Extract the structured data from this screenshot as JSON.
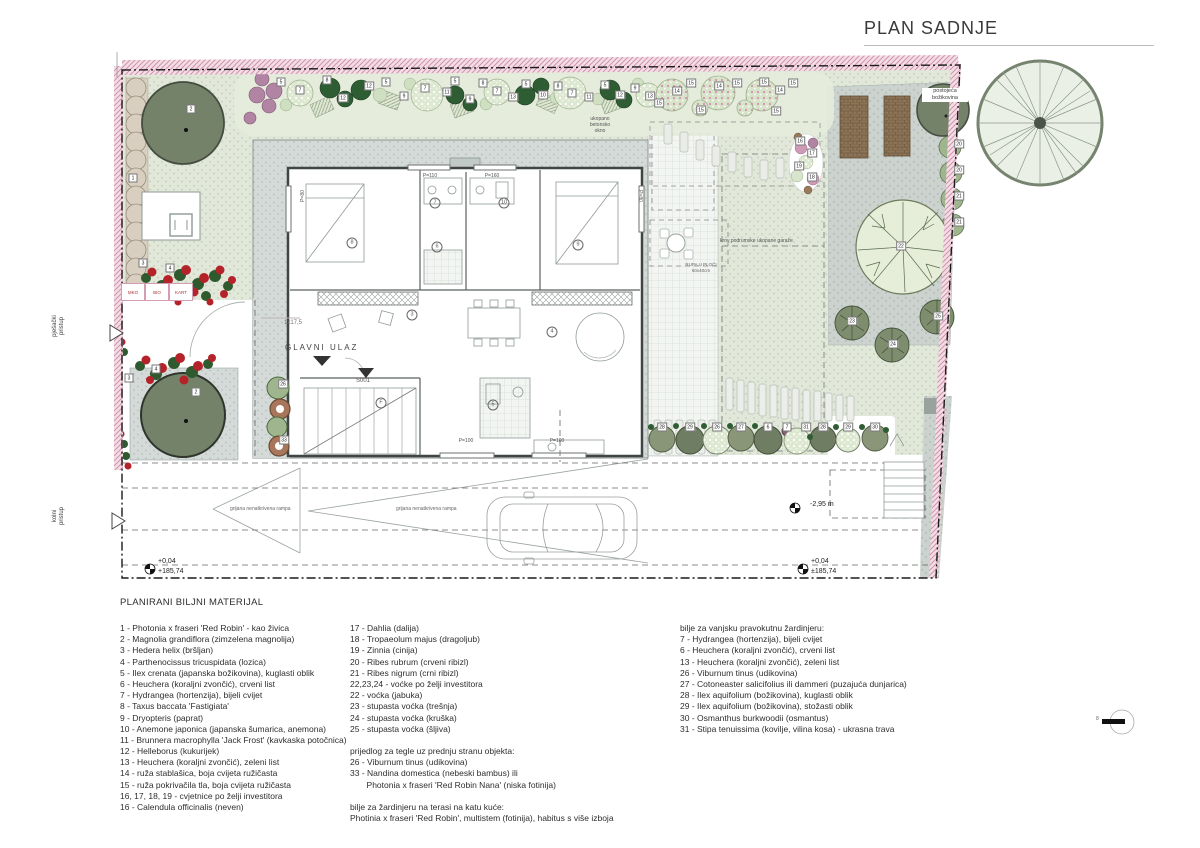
{
  "title": "PLAN SADNJE",
  "scale_mark": "8",
  "plan": {
    "labels": {
      "existing_tree": "postojeća\nbožikovina",
      "buried_shaft": "ukopano\nbetonsko\nokno",
      "garage_roof": "krov podrumske ukopane garaže",
      "main_entrance": "GLAVNI ULAZ",
      "stair_note": "1x17,5",
      "door_code": "S001",
      "hole_in_slab": "RUPA U PLOČI\n60x40cm",
      "ramp_left": "grijana nenatkrivena rampa",
      "ramp_main": "grijana nenatkrivena rampa",
      "pedestrian_access": "pješački\npristup",
      "vehicle_access": "kolni\npristup",
      "depth": "-2,95 m",
      "elev_left_rel": "+0,04",
      "elev_left_abs": "+185,74",
      "elev_right_rel": "+0,04",
      "elev_right_abs": "±185,74"
    },
    "bins": [
      "MKO",
      "BIO",
      "KART"
    ],
    "window_labels": [
      {
        "t": "P=110",
        "x": 430,
        "y": 176,
        "r": 0
      },
      {
        "t": "P=160",
        "x": 492,
        "y": 176,
        "r": 0
      },
      {
        "t": "P=100",
        "x": 466,
        "y": 441,
        "r": 0
      },
      {
        "t": "P=100",
        "x": 557,
        "y": 441,
        "r": 0
      },
      {
        "t": "P=80",
        "x": 303,
        "y": 196,
        "r": -90
      },
      {
        "t": "P=80",
        "x": 640,
        "y": 196,
        "r": 90
      }
    ],
    "room_tags": [
      {
        "t": "7",
        "x": 435,
        "y": 203
      },
      {
        "t": "10",
        "x": 504,
        "y": 203
      },
      {
        "t": "8",
        "x": 352,
        "y": 243
      },
      {
        "t": "6",
        "x": 437,
        "y": 247
      },
      {
        "t": "9",
        "x": 578,
        "y": 245
      },
      {
        "t": "3",
        "x": 412,
        "y": 315
      },
      {
        "t": "4",
        "x": 552,
        "y": 332
      },
      {
        "t": "F",
        "x": 381,
        "y": 403
      },
      {
        "t": "5",
        "x": 493,
        "y": 405
      }
    ],
    "plant_tags": [
      {
        "t": "1",
        "x": 133,
        "y": 178
      },
      {
        "t": "2",
        "x": 191,
        "y": 109
      },
      {
        "t": "3",
        "x": 143,
        "y": 263
      },
      {
        "t": "4",
        "x": 170,
        "y": 268
      },
      {
        "t": "4",
        "x": 156,
        "y": 369
      },
      {
        "t": "3",
        "x": 129,
        "y": 378
      },
      {
        "t": "2",
        "x": 196,
        "y": 392
      },
      {
        "t": "26",
        "x": 283,
        "y": 384
      },
      {
        "t": "33",
        "x": 284,
        "y": 440
      },
      {
        "t": "5",
        "x": 281,
        "y": 82
      },
      {
        "t": "7",
        "x": 300,
        "y": 90
      },
      {
        "t": "8",
        "x": 327,
        "y": 80
      },
      {
        "t": "12",
        "x": 343,
        "y": 98
      },
      {
        "t": "12",
        "x": 369,
        "y": 86
      },
      {
        "t": "5",
        "x": 386,
        "y": 82
      },
      {
        "t": "9",
        "x": 404,
        "y": 96
      },
      {
        "t": "7",
        "x": 425,
        "y": 88
      },
      {
        "t": "11",
        "x": 447,
        "y": 92
      },
      {
        "t": "5",
        "x": 455,
        "y": 81
      },
      {
        "t": "9",
        "x": 470,
        "y": 99
      },
      {
        "t": "8",
        "x": 483,
        "y": 83
      },
      {
        "t": "7",
        "x": 497,
        "y": 91
      },
      {
        "t": "13",
        "x": 513,
        "y": 97
      },
      {
        "t": "5",
        "x": 526,
        "y": 84
      },
      {
        "t": "10",
        "x": 543,
        "y": 95
      },
      {
        "t": "8",
        "x": 558,
        "y": 86
      },
      {
        "t": "7",
        "x": 572,
        "y": 93
      },
      {
        "t": "11",
        "x": 589,
        "y": 97
      },
      {
        "t": "5",
        "x": 605,
        "y": 85
      },
      {
        "t": "12",
        "x": 620,
        "y": 95
      },
      {
        "t": "9",
        "x": 635,
        "y": 88
      },
      {
        "t": "13",
        "x": 650,
        "y": 96
      },
      {
        "t": "15",
        "x": 659,
        "y": 103
      },
      {
        "t": "14",
        "x": 677,
        "y": 91
      },
      {
        "t": "15",
        "x": 691,
        "y": 83
      },
      {
        "t": "14",
        "x": 719,
        "y": 86
      },
      {
        "t": "15",
        "x": 737,
        "y": 83
      },
      {
        "t": "15",
        "x": 701,
        "y": 110
      },
      {
        "t": "15",
        "x": 764,
        "y": 82
      },
      {
        "t": "14",
        "x": 780,
        "y": 90
      },
      {
        "t": "15",
        "x": 793,
        "y": 83
      },
      {
        "t": "15",
        "x": 776,
        "y": 111
      },
      {
        "t": "16",
        "x": 800,
        "y": 141
      },
      {
        "t": "17",
        "x": 812,
        "y": 153
      },
      {
        "t": "19",
        "x": 799,
        "y": 166
      },
      {
        "t": "18",
        "x": 812,
        "y": 177
      },
      {
        "t": "20",
        "x": 959,
        "y": 144
      },
      {
        "t": "20",
        "x": 959,
        "y": 170
      },
      {
        "t": "21",
        "x": 959,
        "y": 196
      },
      {
        "t": "21",
        "x": 959,
        "y": 222
      },
      {
        "t": "22",
        "x": 901,
        "y": 246
      },
      {
        "t": "23",
        "x": 852,
        "y": 321
      },
      {
        "t": "24",
        "x": 893,
        "y": 344
      },
      {
        "t": "25",
        "x": 938,
        "y": 316
      },
      {
        "t": "28",
        "x": 662,
        "y": 427
      },
      {
        "t": "29",
        "x": 690,
        "y": 427
      },
      {
        "t": "26",
        "x": 717,
        "y": 427
      },
      {
        "t": "27",
        "x": 741,
        "y": 427
      },
      {
        "t": "6",
        "x": 768,
        "y": 427
      },
      {
        "t": "7",
        "x": 787,
        "y": 427
      },
      {
        "t": "31",
        "x": 806,
        "y": 427
      },
      {
        "t": "28",
        "x": 823,
        "y": 427
      },
      {
        "t": "29",
        "x": 848,
        "y": 427
      },
      {
        "t": "30",
        "x": 875,
        "y": 427
      }
    ]
  },
  "legend": {
    "heading": "PLANIRANI BILJNI MATERIJAL",
    "col1": [
      "1 - Photonia x fraseri 'Red Robin' - kao živica",
      "2 - Magnolia grandiflora (zimzelena magnolija)",
      "3 - Hedera helix (bršljan)",
      "4 - Parthenocissus tricuspidata (lozica)",
      "5 - Ilex crenata (japanska božikovina), kuglasti oblik",
      "6 - Heuchera (koraljni zvončić), crveni list",
      "7 - Hydrangea (hortenzija), bijeli cvijet",
      "8 - Taxus baccata 'Fastigiata'",
      "9 - Dryopteris (paprat)",
      "10 - Anemone japonica (japanska šumarica, anemona)",
      "11 - Brunnera macrophylla 'Jack Frost' (kavkaska potočnica)",
      "12 - Helleborus (kukurijek)",
      "13 - Heuchera (koraljni zvončić), zeleni list",
      "14 - ruža stablašica, boja cvijeta ružičasta",
      "15 - ruža pokrivačila tla, boja cvijeta ružičasta",
      "16, 17, 18, 19 - cvjetnice po želji investitora",
      "16 - Calendula officinalis (neven)"
    ],
    "col2": [
      "17 - Dahlia (dalija)",
      "18 - Tropaeolum majus (dragoljub)",
      "19 - Zinnia (cinija)",
      "20 - Ribes rubrum (crveni ribizl)",
      "21 - Ribes nigrum (crni ribizl)",
      "22,23,24 - voćke po želji investitora",
      "22 - voćka (jabuka)",
      "23 - stupasta voćka (trešnja)",
      "24 - stupasta voćka (kruška)",
      "25 - stupasta voćka (šljiva)",
      "",
      "prijedlog za tegle uz prednju stranu objekta:",
      "26 - Viburnum tinus (udikovina)",
      "33 - Nandina domestica (nebeski bambus) ili",
      "       Photonia x fraseri 'Red Robin Nana' (niska fotinija)",
      "",
      "bilje za žardinjeru na terasi na katu kuće:",
      "Photinia x fraseri 'Red Robin', multistem (fotinija), habitus s više izboja"
    ],
    "col3": [
      "bilje za vanjsku pravokutnu žardinjeru:",
      "7 - Hydrangea (hortenzija), bijeli cvijet",
      "6 - Heuchera (koraljni zvončić), crveni list",
      "13 - Heuchera (koraljni zvončić), zeleni list",
      "26 - Viburnum tinus (udikovina)",
      "27 - Cotoneaster salicifolius ili dammeri (puzajuća dunjarica)",
      "28 - Ilex aquifolium (božikovina), kuglasti oblik",
      "29 - Ilex aquifolium (božikovina), stožasti oblik",
      "30 - Osmanthus burkwoodii (osmantus)",
      "31 - Stipa tenuissima (kovilje, vilina kosa) - ukrasna trava"
    ]
  }
}
